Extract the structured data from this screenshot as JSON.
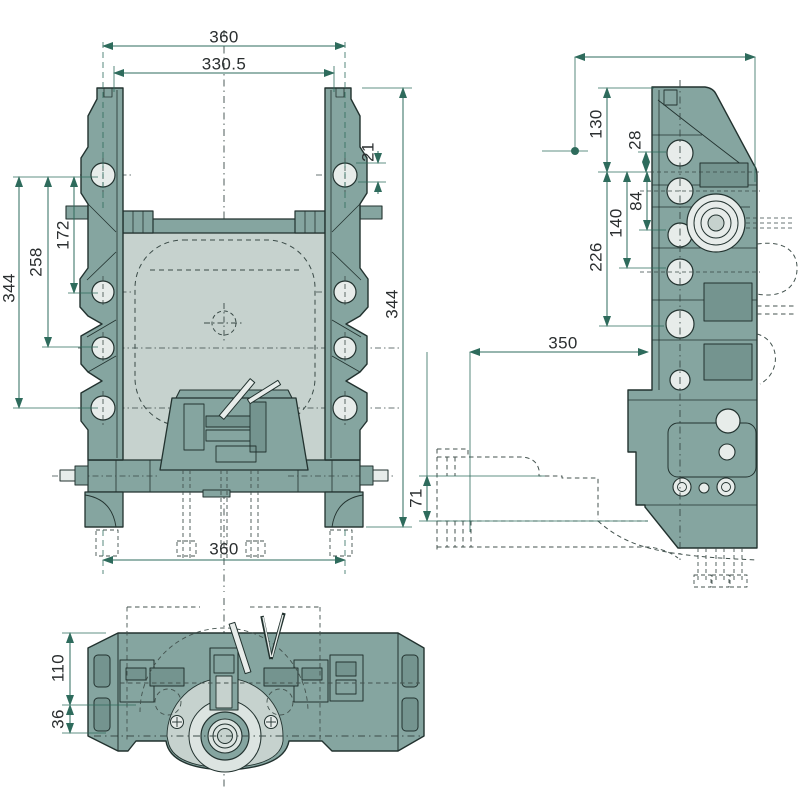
{
  "drawing": {
    "kind": "engineering-drawing",
    "views": [
      "front",
      "side",
      "bottom"
    ],
    "colors": {
      "body": "#85A5A0",
      "body_dark": "#74948F",
      "panel": "#C6D2CE",
      "hole": "#E7ECEA",
      "outline": "#22322F",
      "dimension": "#2E6B5C",
      "phantom": "#44534F",
      "text": "#2B2F30",
      "background": "#FFFFFF"
    }
  },
  "dims": {
    "front": {
      "top_width": "360",
      "inner_width": "330.5",
      "lug_hole_offset": "21",
      "hole_span_small": "172",
      "hole_span_mid": "258",
      "hole_span_full": "344",
      "overall_height": "344",
      "bottom_width": "360"
    },
    "side": {
      "top_offset": "130",
      "hole_offset": "28",
      "span_small": "84",
      "span_mid": "140",
      "span_large": "226",
      "reach": "350",
      "step_height": "71"
    },
    "bottom": {
      "depth": "110",
      "step": "36"
    }
  }
}
